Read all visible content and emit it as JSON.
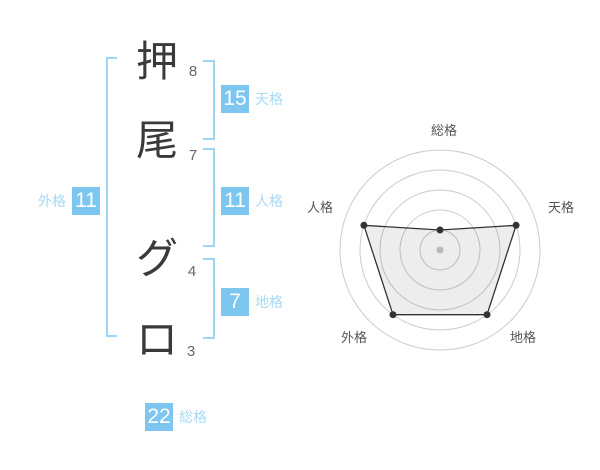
{
  "panel": {
    "name_display": {
      "characters": [
        {
          "char": "押",
          "strokes": "8"
        },
        {
          "char": "尾",
          "strokes": "7"
        },
        {
          "char": "グ",
          "strokes": "4"
        },
        {
          "char": "ロ",
          "strokes": "3"
        }
      ],
      "tenkaku": {
        "value": "15",
        "label": "天格"
      },
      "jinkaku": {
        "value": "11",
        "label": "人格"
      },
      "chikaku": {
        "value": "7",
        "label": "地格"
      },
      "gaikaku": {
        "value": "11",
        "label": "外格"
      },
      "soukaku": {
        "value": "22",
        "label": "総格"
      }
    }
  },
  "chart_data": {
    "type": "radar",
    "axes": [
      "総格",
      "天格",
      "地格",
      "外格",
      "人格"
    ],
    "values": [
      1,
      4,
      4,
      4,
      4
    ],
    "scale_max": 5,
    "rings": 5,
    "grid": "circular",
    "legend": "none",
    "center_marker": true
  },
  "theme": {
    "accent_blue": "#7cc6ef",
    "light_blue_label": "#a6daf6",
    "bracket_blue": "#9dd7f5",
    "char_color": "#3a3a3a",
    "stroke_number_color": "#666666",
    "ring_color": "#cccccc",
    "polygon_color": "#333333",
    "polygon_fill": "rgba(0,0,0,0.07)",
    "axis_label_color": "#555555",
    "center_dot_color": "#bbbbbb",
    "background": "#ffffff"
  }
}
